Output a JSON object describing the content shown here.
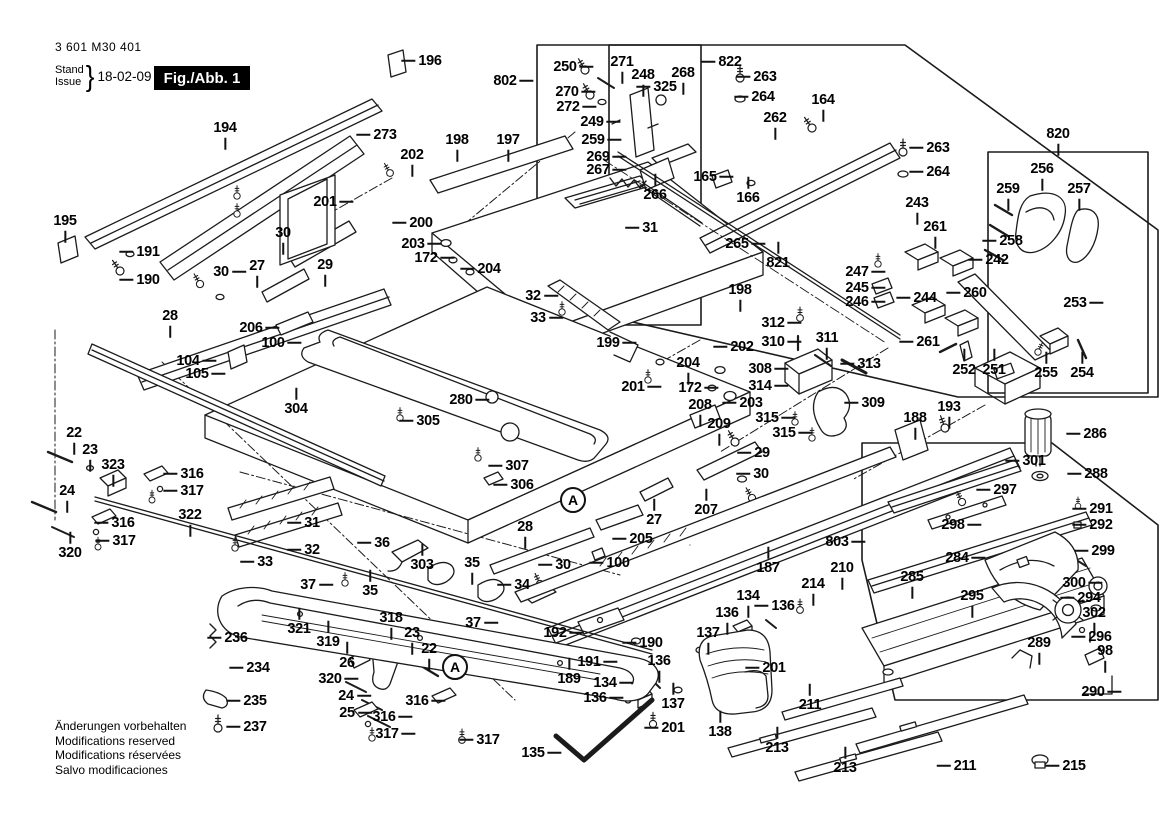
{
  "header": {
    "part_number": "3 601 M30 401",
    "stand_label": "Stand",
    "issue_label": "Issue",
    "brace": "}",
    "date": "18-02-09",
    "figure_label": "Fig./Abb. 1"
  },
  "footer": {
    "lines": [
      "Änderungen vorbehalten",
      "Modifications reserved",
      "Modifications réservées",
      "Salvo modificaciones"
    ]
  },
  "colors": {
    "line": "#1b1b1b",
    "figure_box_bg": "#000000",
    "figure_box_text": "#ffffff"
  },
  "detail_markers": [
    {
      "label": "A",
      "x": 573,
      "y": 500
    },
    {
      "label": "A",
      "x": 455,
      "y": 667
    }
  ],
  "callouts": [
    {
      "t": "194",
      "x": 225,
      "y": 128,
      "d": "d"
    },
    {
      "t": "195",
      "x": 65,
      "y": 221,
      "d": "d"
    },
    {
      "t": "191",
      "x": 148,
      "y": 252,
      "d": "l"
    },
    {
      "t": "190",
      "x": 148,
      "y": 280,
      "d": "l"
    },
    {
      "t": "273",
      "x": 385,
      "y": 135,
      "d": "l"
    },
    {
      "t": "196",
      "x": 430,
      "y": 61,
      "d": "l"
    },
    {
      "t": "202",
      "x": 412,
      "y": 155,
      "d": "d"
    },
    {
      "t": "198",
      "x": 457,
      "y": 140,
      "d": "d"
    },
    {
      "t": "197",
      "x": 508,
      "y": 140,
      "d": "d"
    },
    {
      "t": "201",
      "x": 325,
      "y": 202,
      "d": "r"
    },
    {
      "t": "30",
      "x": 283,
      "y": 233,
      "d": "d"
    },
    {
      "t": "200",
      "x": 421,
      "y": 223,
      "d": "l"
    },
    {
      "t": "203",
      "x": 413,
      "y": 244,
      "d": "r"
    },
    {
      "t": "172",
      "x": 426,
      "y": 258,
      "d": "r"
    },
    {
      "t": "204",
      "x": 489,
      "y": 269,
      "d": "l"
    },
    {
      "t": "30",
      "x": 221,
      "y": 272,
      "d": "r"
    },
    {
      "t": "27",
      "x": 257,
      "y": 266,
      "d": "d"
    },
    {
      "t": "29",
      "x": 325,
      "y": 265,
      "d": "d"
    },
    {
      "t": "28",
      "x": 170,
      "y": 316,
      "d": "d"
    },
    {
      "t": "206",
      "x": 251,
      "y": 328,
      "d": "r"
    },
    {
      "t": "100",
      "x": 273,
      "y": 343,
      "d": "r"
    },
    {
      "t": "104",
      "x": 188,
      "y": 361,
      "d": "r"
    },
    {
      "t": "105",
      "x": 197,
      "y": 374,
      "d": "r"
    },
    {
      "t": "304",
      "x": 296,
      "y": 409,
      "d": "u"
    },
    {
      "t": "305",
      "x": 428,
      "y": 421,
      "d": "l"
    },
    {
      "t": "280",
      "x": 461,
      "y": 400,
      "d": "r"
    },
    {
      "t": "307",
      "x": 517,
      "y": 466,
      "d": "l"
    },
    {
      "t": "306",
      "x": 522,
      "y": 485,
      "d": "l"
    },
    {
      "t": "32",
      "x": 533,
      "y": 296,
      "d": "r"
    },
    {
      "t": "33",
      "x": 538,
      "y": 318,
      "d": "r"
    },
    {
      "t": "199",
      "x": 608,
      "y": 343,
      "d": "r"
    },
    {
      "t": "31",
      "x": 650,
      "y": 228,
      "d": "l"
    },
    {
      "t": "802",
      "x": 505,
      "y": 81,
      "d": "r"
    },
    {
      "t": "250",
      "x": 565,
      "y": 67,
      "d": "r"
    },
    {
      "t": "271",
      "x": 622,
      "y": 62,
      "d": "d"
    },
    {
      "t": "248",
      "x": 643,
      "y": 75,
      "d": "d"
    },
    {
      "t": "268",
      "x": 683,
      "y": 73,
      "d": "d"
    },
    {
      "t": "325",
      "x": 665,
      "y": 87,
      "d": "l"
    },
    {
      "t": "822",
      "x": 730,
      "y": 62,
      "d": "l"
    },
    {
      "t": "263",
      "x": 765,
      "y": 77,
      "d": "l"
    },
    {
      "t": "264",
      "x": 763,
      "y": 97,
      "d": "l"
    },
    {
      "t": "270",
      "x": 567,
      "y": 92,
      "d": "r"
    },
    {
      "t": "272",
      "x": 568,
      "y": 107,
      "d": "r"
    },
    {
      "t": "249",
      "x": 592,
      "y": 122,
      "d": "r"
    },
    {
      "t": "259",
      "x": 593,
      "y": 140,
      "d": "r"
    },
    {
      "t": "269",
      "x": 598,
      "y": 157,
      "d": "r"
    },
    {
      "t": "267",
      "x": 598,
      "y": 170,
      "d": "r"
    },
    {
      "t": "266",
      "x": 655,
      "y": 195,
      "d": "u"
    },
    {
      "t": "165",
      "x": 705,
      "y": 177,
      "d": "r"
    },
    {
      "t": "166",
      "x": 748,
      "y": 198,
      "d": "u"
    },
    {
      "t": "262",
      "x": 775,
      "y": 118,
      "d": "d"
    },
    {
      "t": "164",
      "x": 823,
      "y": 100,
      "d": "d"
    },
    {
      "t": "263",
      "x": 938,
      "y": 148,
      "d": "l"
    },
    {
      "t": "264",
      "x": 938,
      "y": 172,
      "d": "l"
    },
    {
      "t": "820",
      "x": 1058,
      "y": 134,
      "d": "d"
    },
    {
      "t": "256",
      "x": 1042,
      "y": 169,
      "d": "d"
    },
    {
      "t": "257",
      "x": 1079,
      "y": 189,
      "d": "d"
    },
    {
      "t": "259",
      "x": 1008,
      "y": 189,
      "d": "d"
    },
    {
      "t": "258",
      "x": 1011,
      "y": 241,
      "d": "l"
    },
    {
      "t": "243",
      "x": 917,
      "y": 203,
      "d": "d"
    },
    {
      "t": "261",
      "x": 935,
      "y": 227,
      "d": "d"
    },
    {
      "t": "242",
      "x": 997,
      "y": 260,
      "d": "l"
    },
    {
      "t": "260",
      "x": 975,
      "y": 293,
      "d": "l"
    },
    {
      "t": "244",
      "x": 925,
      "y": 298,
      "d": "l"
    },
    {
      "t": "261",
      "x": 928,
      "y": 342,
      "d": "l"
    },
    {
      "t": "252",
      "x": 964,
      "y": 370,
      "d": "u"
    },
    {
      "t": "251",
      "x": 994,
      "y": 370,
      "d": "u"
    },
    {
      "t": "253",
      "x": 1075,
      "y": 303,
      "d": "r"
    },
    {
      "t": "255",
      "x": 1046,
      "y": 373,
      "d": "u"
    },
    {
      "t": "254",
      "x": 1082,
      "y": 373,
      "d": "u"
    },
    {
      "t": "265",
      "x": 737,
      "y": 244,
      "d": "r"
    },
    {
      "t": "821",
      "x": 778,
      "y": 263,
      "d": "u"
    },
    {
      "t": "247",
      "x": 857,
      "y": 272,
      "d": "r"
    },
    {
      "t": "245",
      "x": 857,
      "y": 288,
      "d": "r"
    },
    {
      "t": "246",
      "x": 857,
      "y": 302,
      "d": "r"
    },
    {
      "t": "198",
      "x": 740,
      "y": 290,
      "d": "d"
    },
    {
      "t": "202",
      "x": 742,
      "y": 347,
      "d": "l"
    },
    {
      "t": "312",
      "x": 773,
      "y": 323,
      "d": "r"
    },
    {
      "t": "310",
      "x": 773,
      "y": 342,
      "d": "r"
    },
    {
      "t": "311",
      "x": 827,
      "y": 338,
      "d": "d"
    },
    {
      "t": "313",
      "x": 869,
      "y": 364,
      "d": "l"
    },
    {
      "t": "308",
      "x": 760,
      "y": 369,
      "d": "r"
    },
    {
      "t": "314",
      "x": 760,
      "y": 386,
      "d": "r"
    },
    {
      "t": "203",
      "x": 751,
      "y": 403,
      "d": "l"
    },
    {
      "t": "315",
      "x": 767,
      "y": 418,
      "d": "r"
    },
    {
      "t": "315",
      "x": 784,
      "y": 433,
      "d": "r"
    },
    {
      "t": "309",
      "x": 873,
      "y": 403,
      "d": "l"
    },
    {
      "t": "209",
      "x": 719,
      "y": 424,
      "d": "d"
    },
    {
      "t": "208",
      "x": 700,
      "y": 405,
      "d": "d"
    },
    {
      "t": "201",
      "x": 633,
      "y": 387,
      "d": "r"
    },
    {
      "t": "172",
      "x": 690,
      "y": 388,
      "d": "r"
    },
    {
      "t": "204",
      "x": 688,
      "y": 363,
      "d": "d"
    },
    {
      "t": "188",
      "x": 915,
      "y": 418,
      "d": "d"
    },
    {
      "t": "193",
      "x": 949,
      "y": 407,
      "d": "d"
    },
    {
      "t": "29",
      "x": 762,
      "y": 453,
      "d": "l"
    },
    {
      "t": "30",
      "x": 761,
      "y": 474,
      "d": "l"
    },
    {
      "t": "27",
      "x": 654,
      "y": 520,
      "d": "u"
    },
    {
      "t": "207",
      "x": 706,
      "y": 510,
      "d": "u"
    },
    {
      "t": "205",
      "x": 641,
      "y": 539,
      "d": "l"
    },
    {
      "t": "100",
      "x": 618,
      "y": 563,
      "d": "l"
    },
    {
      "t": "30",
      "x": 563,
      "y": 565,
      "d": "l"
    },
    {
      "t": "187",
      "x": 768,
      "y": 568,
      "d": "u"
    },
    {
      "t": "803",
      "x": 837,
      "y": 542,
      "d": "r"
    },
    {
      "t": "210",
      "x": 842,
      "y": 568,
      "d": "d"
    },
    {
      "t": "214",
      "x": 813,
      "y": 584,
      "d": "d"
    },
    {
      "t": "301",
      "x": 1034,
      "y": 461,
      "d": "l"
    },
    {
      "t": "286",
      "x": 1095,
      "y": 434,
      "d": "l"
    },
    {
      "t": "288",
      "x": 1096,
      "y": 474,
      "d": "l"
    },
    {
      "t": "297",
      "x": 1005,
      "y": 490,
      "d": "l"
    },
    {
      "t": "298",
      "x": 953,
      "y": 525,
      "d": "r"
    },
    {
      "t": "291",
      "x": 1101,
      "y": 509,
      "d": "l"
    },
    {
      "t": "292",
      "x": 1101,
      "y": 525,
      "d": "l"
    },
    {
      "t": "284",
      "x": 957,
      "y": 558,
      "d": "r"
    },
    {
      "t": "299",
      "x": 1103,
      "y": 551,
      "d": "l"
    },
    {
      "t": "300",
      "x": 1074,
      "y": 583,
      "d": "r"
    },
    {
      "t": "294",
      "x": 1089,
      "y": 598,
      "d": "l"
    },
    {
      "t": "302",
      "x": 1094,
      "y": 613,
      "d": "d"
    },
    {
      "t": "295",
      "x": 972,
      "y": 596,
      "d": "d"
    },
    {
      "t": "285",
      "x": 912,
      "y": 577,
      "d": "d"
    },
    {
      "t": "289",
      "x": 1039,
      "y": 643,
      "d": "d"
    },
    {
      "t": "296",
      "x": 1100,
      "y": 637,
      "d": "l"
    },
    {
      "t": "98",
      "x": 1105,
      "y": 651,
      "d": "d"
    },
    {
      "t": "290",
      "x": 1093,
      "y": 692,
      "d": "r"
    },
    {
      "t": "211",
      "x": 810,
      "y": 705,
      "d": "u"
    },
    {
      "t": "213",
      "x": 777,
      "y": 748,
      "d": "u"
    },
    {
      "t": "213",
      "x": 845,
      "y": 768,
      "d": "u"
    },
    {
      "t": "211",
      "x": 965,
      "y": 766,
      "d": "l"
    },
    {
      "t": "215",
      "x": 1074,
      "y": 766,
      "d": "l"
    },
    {
      "t": "192",
      "x": 555,
      "y": 633,
      "d": "r"
    },
    {
      "t": "190",
      "x": 651,
      "y": 643,
      "d": "l"
    },
    {
      "t": "191",
      "x": 589,
      "y": 662,
      "d": "r"
    },
    {
      "t": "189",
      "x": 569,
      "y": 679,
      "d": "u"
    },
    {
      "t": "134",
      "x": 748,
      "y": 596,
      "d": "d"
    },
    {
      "t": "136",
      "x": 727,
      "y": 613,
      "d": "d"
    },
    {
      "t": "136",
      "x": 783,
      "y": 606,
      "d": "l"
    },
    {
      "t": "137",
      "x": 708,
      "y": 633,
      "d": "d"
    },
    {
      "t": "201",
      "x": 774,
      "y": 668,
      "d": "l"
    },
    {
      "t": "134",
      "x": 605,
      "y": 683,
      "d": "r"
    },
    {
      "t": "136",
      "x": 595,
      "y": 698,
      "d": "r"
    },
    {
      "t": "136",
      "x": 659,
      "y": 661,
      "d": "d"
    },
    {
      "t": "137",
      "x": 673,
      "y": 704,
      "d": "u"
    },
    {
      "t": "201",
      "x": 673,
      "y": 728,
      "d": "l"
    },
    {
      "t": "138",
      "x": 720,
      "y": 732,
      "d": "u"
    },
    {
      "t": "135",
      "x": 533,
      "y": 753,
      "d": "r"
    },
    {
      "t": "22",
      "x": 74,
      "y": 433,
      "d": "d"
    },
    {
      "t": "23",
      "x": 90,
      "y": 450,
      "d": "d"
    },
    {
      "t": "323",
      "x": 113,
      "y": 465,
      "d": "d"
    },
    {
      "t": "316",
      "x": 192,
      "y": 474,
      "d": "l"
    },
    {
      "t": "317",
      "x": 192,
      "y": 491,
      "d": "l"
    },
    {
      "t": "24",
      "x": 67,
      "y": 491,
      "d": "d"
    },
    {
      "t": "316",
      "x": 123,
      "y": 523,
      "d": "l"
    },
    {
      "t": "317",
      "x": 124,
      "y": 541,
      "d": "l"
    },
    {
      "t": "320",
      "x": 70,
      "y": 553,
      "d": "u"
    },
    {
      "t": "322",
      "x": 190,
      "y": 515,
      "d": "d"
    },
    {
      "t": "31",
      "x": 312,
      "y": 523,
      "d": "l"
    },
    {
      "t": "32",
      "x": 312,
      "y": 550,
      "d": "l"
    },
    {
      "t": "33",
      "x": 265,
      "y": 562,
      "d": "l"
    },
    {
      "t": "36",
      "x": 382,
      "y": 543,
      "d": "l"
    },
    {
      "t": "303",
      "x": 422,
      "y": 565,
      "d": "u"
    },
    {
      "t": "37",
      "x": 308,
      "y": 585,
      "d": "r"
    },
    {
      "t": "35",
      "x": 370,
      "y": 591,
      "d": "u"
    },
    {
      "t": "35",
      "x": 472,
      "y": 563,
      "d": "d"
    },
    {
      "t": "34",
      "x": 522,
      "y": 585,
      "d": "l"
    },
    {
      "t": "37",
      "x": 473,
      "y": 623,
      "d": "r"
    },
    {
      "t": "28",
      "x": 525,
      "y": 527,
      "d": "d"
    },
    {
      "t": "321",
      "x": 299,
      "y": 629,
      "d": "u"
    },
    {
      "t": "319",
      "x": 328,
      "y": 642,
      "d": "u"
    },
    {
      "t": "318",
      "x": 391,
      "y": 618,
      "d": "d"
    },
    {
      "t": "23",
      "x": 412,
      "y": 633,
      "d": "d"
    },
    {
      "t": "22",
      "x": 429,
      "y": 649,
      "d": "d"
    },
    {
      "t": "26",
      "x": 347,
      "y": 663,
      "d": "u"
    },
    {
      "t": "320",
      "x": 330,
      "y": 679,
      "d": "r"
    },
    {
      "t": "24",
      "x": 346,
      "y": 696,
      "d": "r"
    },
    {
      "t": "25",
      "x": 347,
      "y": 713,
      "d": "r"
    },
    {
      "t": "316",
      "x": 417,
      "y": 701,
      "d": "r"
    },
    {
      "t": "316",
      "x": 384,
      "y": 717,
      "d": "r"
    },
    {
      "t": "317",
      "x": 387,
      "y": 734,
      "d": "r"
    },
    {
      "t": "317",
      "x": 488,
      "y": 740,
      "d": "l"
    },
    {
      "t": "236",
      "x": 236,
      "y": 638,
      "d": "l"
    },
    {
      "t": "234",
      "x": 258,
      "y": 668,
      "d": "l"
    },
    {
      "t": "235",
      "x": 255,
      "y": 701,
      "d": "l"
    },
    {
      "t": "237",
      "x": 255,
      "y": 727,
      "d": "l"
    }
  ]
}
